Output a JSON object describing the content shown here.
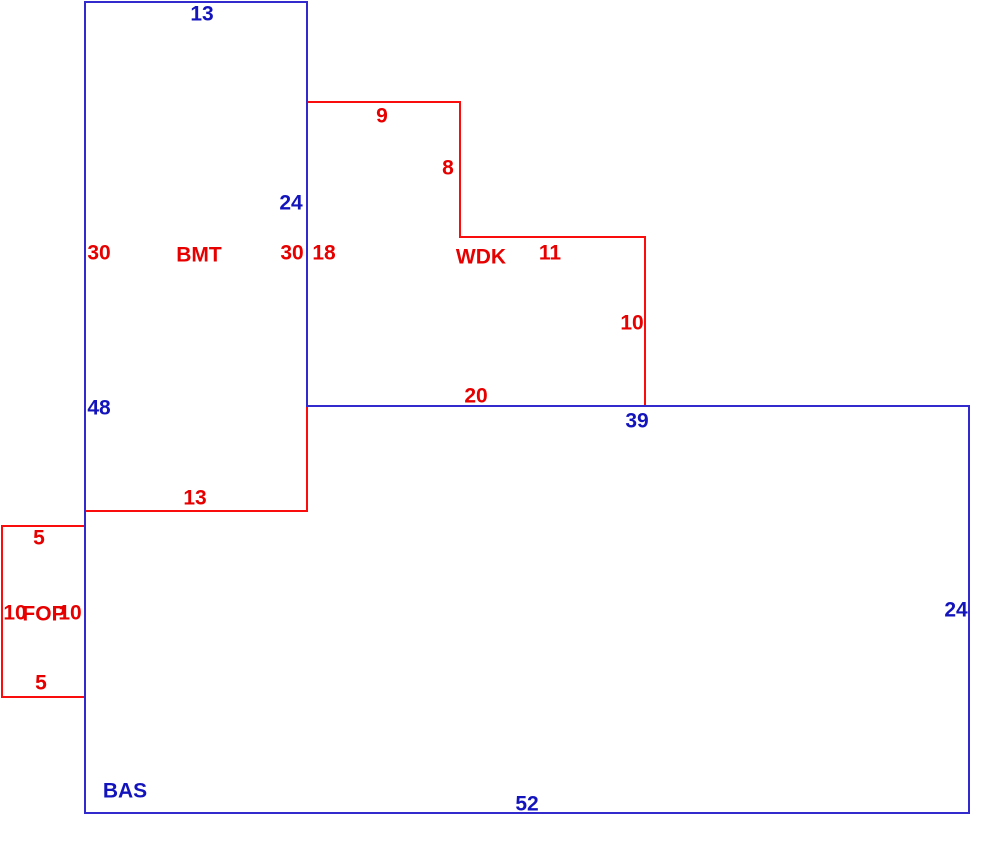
{
  "colors": {
    "line_blue": "#332acd",
    "text_blue": "#1414bc",
    "line_red": "#fa0d0d",
    "text_red": "#e60000",
    "background": "#ffffff"
  },
  "areas": {
    "bas": {
      "code": "BAS",
      "dims": {
        "top_width": "13",
        "upper_right_side": "24",
        "left_side": "48",
        "inner_top": "39",
        "right_side": "24",
        "bottom": "52"
      }
    },
    "bmt": {
      "code": "BMT",
      "dims": {
        "left": "30",
        "right": "30",
        "bottom": "13"
      }
    },
    "wdk": {
      "code": "WDK",
      "dims": {
        "left": "18",
        "top": "9",
        "upper_right": "8",
        "step": "11",
        "lower_right": "10",
        "bottom": "20"
      }
    },
    "fop": {
      "code": "FOP",
      "dims": {
        "top": "5",
        "left": "10",
        "right": "10",
        "bottom": "5"
      }
    }
  }
}
